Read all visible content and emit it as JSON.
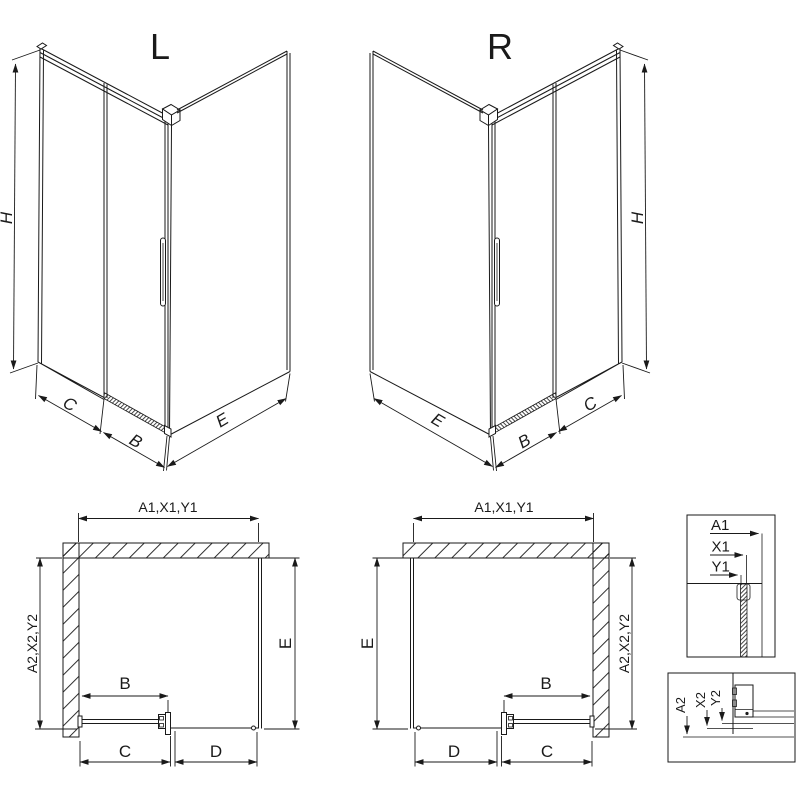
{
  "colors": {
    "line": "#1a1a1a",
    "background": "#ffffff"
  },
  "iso_left": {
    "variant_label": "L",
    "height_dim": "H",
    "front_dim": "C",
    "door_dim": "B",
    "side_dim": "E"
  },
  "iso_right": {
    "variant_label": "R",
    "height_dim": "H",
    "front_dim": "C",
    "door_dim": "B",
    "side_dim": "E"
  },
  "plan_left": {
    "top_dim": "A1,X1,Y1",
    "left_dim": "A2,X2,Y2",
    "right_dim": "E",
    "door_dim": "B",
    "bottom_left_dim": "C",
    "bottom_right_dim": "D"
  },
  "plan_right": {
    "top_dim": "A1,X1,Y1",
    "left_dim": "E",
    "right_dim": "A2,X2,Y2",
    "door_dim": "B",
    "bottom_left_dim": "D",
    "bottom_right_dim": "C"
  },
  "detail_top": {
    "labels": [
      "A1",
      "X1",
      "Y1"
    ]
  },
  "detail_bottom": {
    "labels": [
      "A2",
      "X2",
      "Y2"
    ]
  }
}
